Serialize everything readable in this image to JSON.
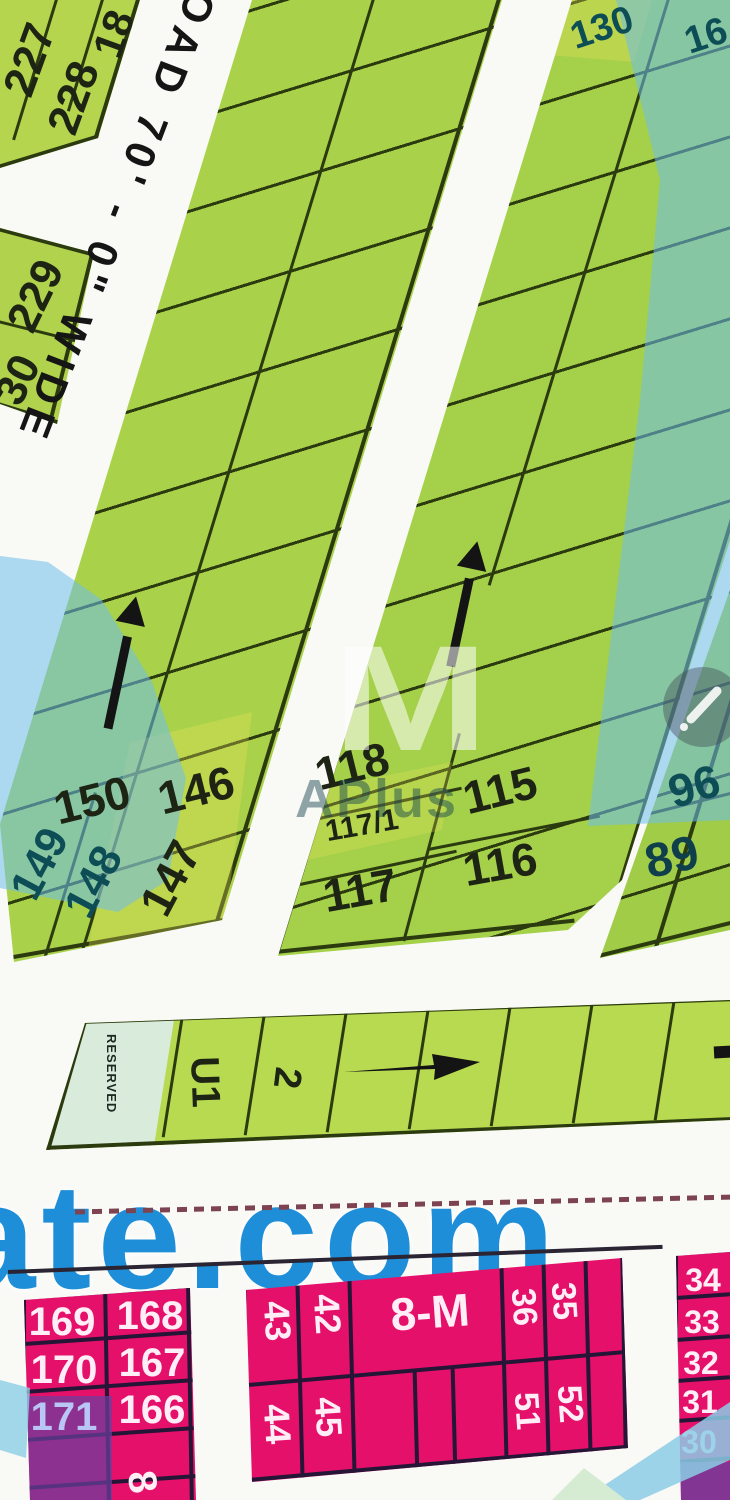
{
  "map": {
    "type": "housing-plot-map",
    "roads": {
      "main_label": "OAD 70' - 0\" WIDE"
    },
    "watermark": {
      "logo": "M",
      "brand": "APlus",
      "site_text": "ate.com"
    },
    "green_zone": {
      "top_left_block": {
        "plots": [
          "227",
          "228",
          "18"
        ]
      },
      "left_edge_block": {
        "plots": [
          "229",
          "30"
        ]
      },
      "column_a": {
        "bottom_plots": [
          "150",
          "146",
          "149",
          "148",
          "147"
        ]
      },
      "column_b": {
        "top_plots": [
          "130",
          "16"
        ],
        "bottom_plots": [
          "118",
          "117/1",
          "117",
          "115",
          "116"
        ]
      },
      "column_c": {
        "bottom_plots": [
          "96",
          "89"
        ]
      }
    },
    "strip": {
      "reserved": "RESERVED",
      "plots": [
        "U1",
        "2"
      ]
    },
    "pink_zone": {
      "left_block": {
        "rows": [
          [
            "169",
            "168"
          ],
          [
            "170",
            "167"
          ],
          [
            "171",
            "166"
          ]
        ],
        "partial_plot": "8"
      },
      "middle_block": {
        "block_label": "8-M",
        "top_plots": [
          "43",
          "42",
          "36",
          "35"
        ],
        "bottom_plots": [
          "44",
          "45",
          "51",
          "52"
        ]
      },
      "right_strip": {
        "plots": [
          "34",
          "33",
          "32",
          "31",
          "30"
        ]
      }
    },
    "colors": {
      "plot_green": "#a9d24a",
      "plot_pink": "#e5106a",
      "overlay_blue": "#6ebeeb",
      "overlay_purple": "#6a3e9e",
      "watermark_blue": "#2191d8",
      "grid_line": "#2c3a10"
    }
  }
}
